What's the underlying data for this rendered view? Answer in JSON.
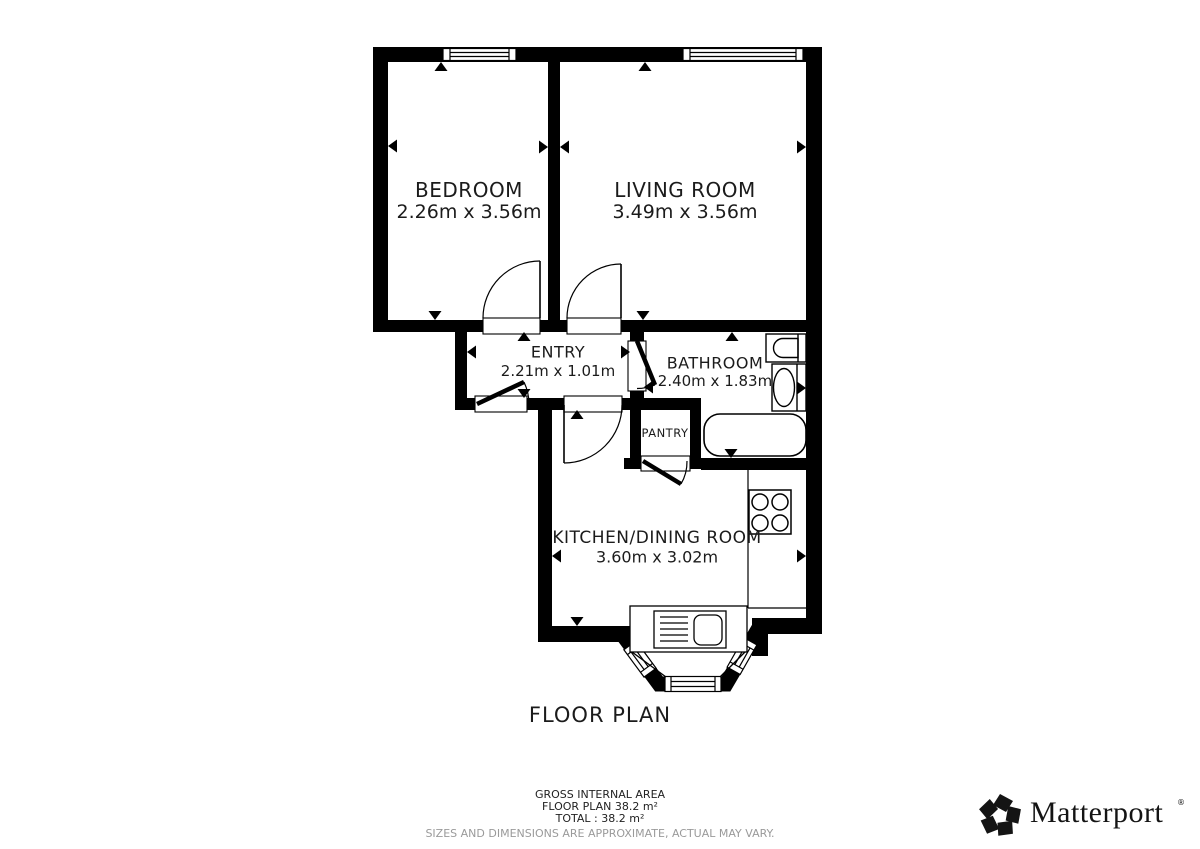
{
  "title": "FLOOR PLAN",
  "rooms": [
    {
      "name": "BEDROOM",
      "dims": "2.26m x 3.56m"
    },
    {
      "name": "LIVING ROOM",
      "dims": "3.49m x 3.56m"
    },
    {
      "name": "ENTRY",
      "dims": "2.21m x 1.01m"
    },
    {
      "name": "BATHROOM",
      "dims": "2.40m x 1.83m"
    },
    {
      "name": "PANTRY",
      "dims": ""
    },
    {
      "name": "KITCHEN/DINING ROOM",
      "dims": "3.60m x 3.02m"
    }
  ],
  "footer": {
    "line1": "GROSS INTERNAL AREA",
    "line2": "FLOOR PLAN 38.2 m²",
    "line3": "TOTAL :  38.2 m²",
    "disclaimer": "SIZES AND DIMENSIONS ARE APPROXIMATE, ACTUAL MAY VARY."
  },
  "brand": {
    "name": "Matterport",
    "registered": "®"
  },
  "colors": {
    "wall": "#000000",
    "line": "#000000",
    "disclaimer_gray": "#9a9a9a",
    "background": "#ffffff"
  }
}
